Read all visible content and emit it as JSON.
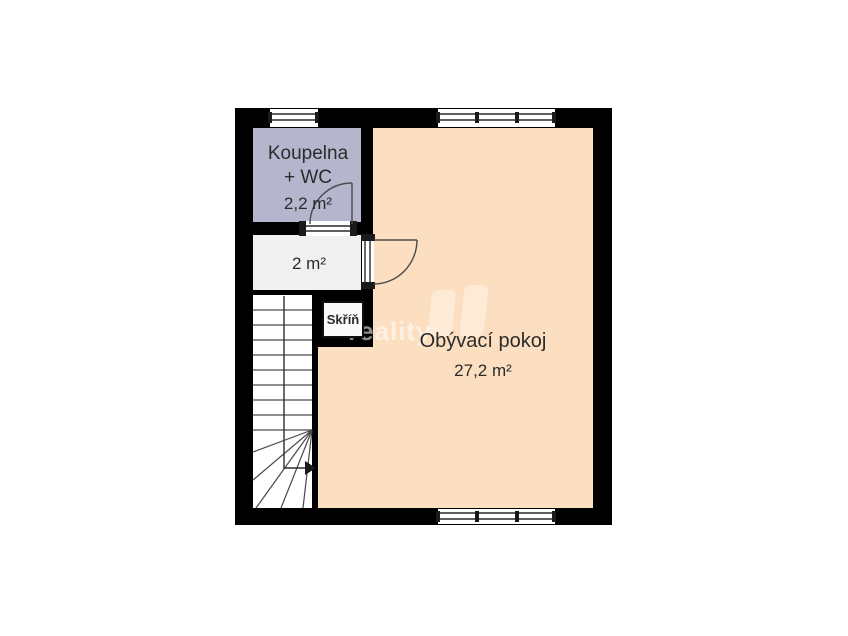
{
  "rooms": {
    "bathroom": {
      "name_line1": "Koupelna",
      "name_line2": "+ WC",
      "area": "2,2 m²"
    },
    "hall": {
      "area": "2 m²"
    },
    "closet": {
      "name": "Skříň"
    },
    "living_room": {
      "name": "Obývací pokoj",
      "area": "27,2 m²"
    }
  },
  "watermark": {
    "text": "reality"
  },
  "colors": {
    "background": "#ffffff",
    "wall": "#000000",
    "bathroom_fill": "#b5b6ce",
    "hall_fill": "#f0f0f0",
    "stairs_fill": "#ffffff",
    "living_fill": "#fcdfc1",
    "closet_fill": "#fafafa",
    "line": "#4a4a4a",
    "label_text": "#2b2b2b",
    "watermark_text": "rgba(255,255,255,0.55)",
    "watermark_logo": "rgba(255,255,255,0.38)"
  }
}
